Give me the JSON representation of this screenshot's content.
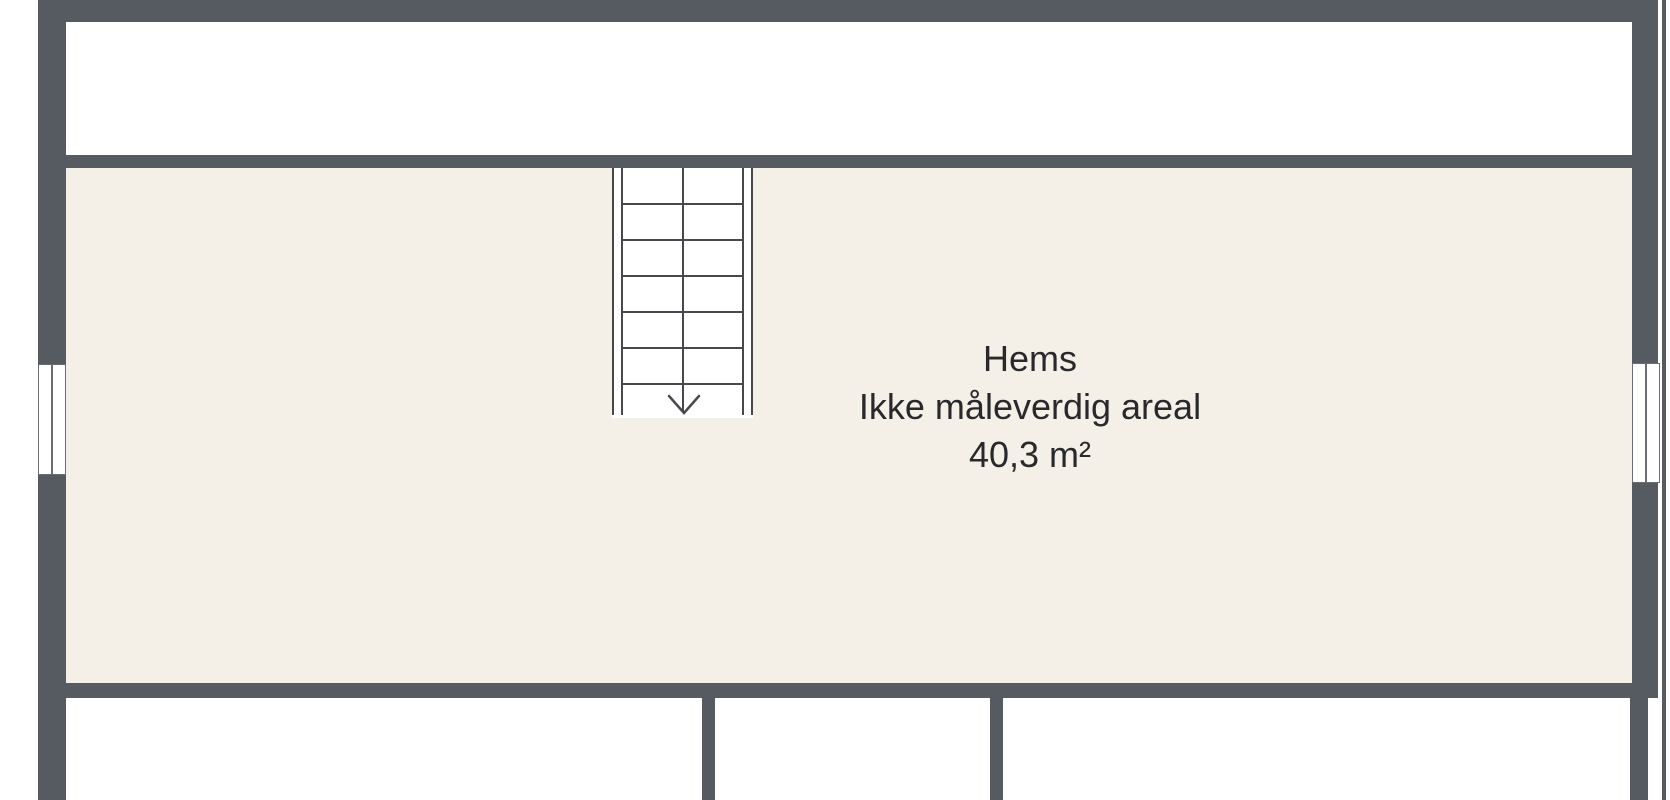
{
  "plan": {
    "room_label": {
      "name": "Hems",
      "note": "Ikke måleverdig areal",
      "area": "40,3 m²"
    },
    "stair": {
      "steps": 6,
      "direction": "down"
    },
    "colors": {
      "wall": "#565a61",
      "floor": "#f5f0e7",
      "line": "#46484c",
      "frame": "#6a6d73",
      "text": "#28292c",
      "background": "#ffffff"
    }
  }
}
